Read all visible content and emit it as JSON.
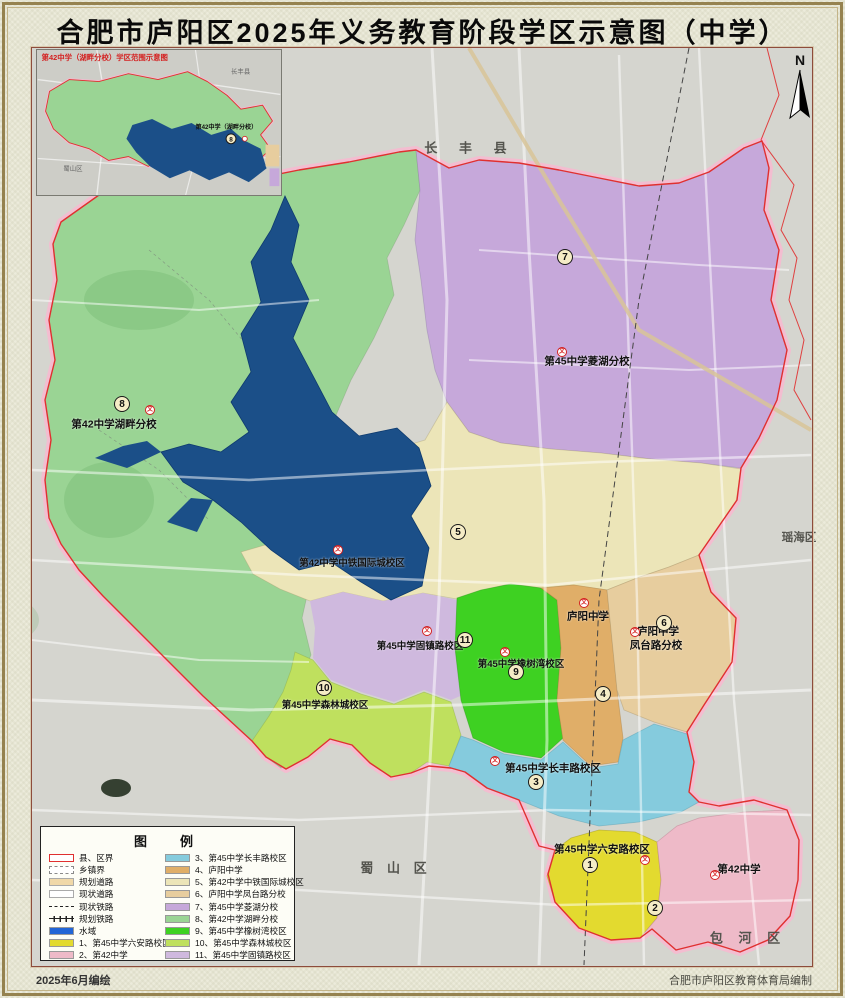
{
  "title": "合肥市庐阳区2025年义务教育阶段学区示意图（中学）",
  "north": {
    "label": "N"
  },
  "inset": {
    "caption": "第42中学（湖畔分校）学区范围示意图",
    "label": "第42中学（湖畔分校）",
    "num": "8",
    "districts": [
      {
        "text": "长丰县"
      },
      {
        "text": "蜀山区"
      }
    ]
  },
  "map": {
    "marker": "文",
    "districts": [
      {
        "text": "长 丰 县"
      },
      {
        "text": "瑶海区"
      },
      {
        "text": "蜀 山 区"
      },
      {
        "text": "包 河 区"
      }
    ],
    "schools": [
      {
        "text": "第45中学菱湖分校"
      },
      {
        "text": "第42中学湖畔分校"
      },
      {
        "text": "第42中学中铁国际城校区"
      },
      {
        "text": "第45中学固镇路校区"
      },
      {
        "text": "庐阳中学"
      },
      {
        "text": "庐阳中学"
      },
      {
        "text": "凤台路分校"
      },
      {
        "text": "第45中学橡树湾校区"
      },
      {
        "text": "第45中学森林城校区"
      },
      {
        "text": "第45中学长丰路校区"
      },
      {
        "text": "第45中学六安路校区"
      },
      {
        "text": "第42中学"
      }
    ],
    "numbers": [
      "1",
      "2",
      "3",
      "4",
      "5",
      "6",
      "7",
      "8",
      "9",
      "10",
      "11"
    ]
  },
  "legend": {
    "title": "图　例",
    "left": [
      {
        "label": "县、区界",
        "fill": "#ffffff"
      },
      {
        "label": "乡镇界",
        "fill": "#ffffff"
      },
      {
        "label": "规划道路",
        "fill": "#f0d8a8"
      },
      {
        "label": "现状道路",
        "fill": "#ffffff"
      },
      {
        "label": "现状铁路",
        "fill": ""
      },
      {
        "label": "规划铁路",
        "fill": ""
      },
      {
        "label": "水域",
        "fill": "#2165d6"
      },
      {
        "label": "1、第45中学六安路校区",
        "fill": "#e3da2f"
      },
      {
        "label": "2、第42中学",
        "fill": "#eebac8"
      }
    ],
    "right": [
      {
        "label": "3、第45中学长丰路校区",
        "fill": "#85cbdd"
      },
      {
        "label": "4、庐阳中学",
        "fill": "#e0ae68"
      },
      {
        "label": "5、第42中学中铁国际城校区",
        "fill": "#ece5b8"
      },
      {
        "label": "6、庐阳中学凤台路分校",
        "fill": "#e7cd9e"
      },
      {
        "label": "7、第45中学菱湖分校",
        "fill": "#c6a8da"
      },
      {
        "label": "8、第42中学湖畔分校",
        "fill": "#9ad494"
      },
      {
        "label": "9、第45中学橡树湾校区",
        "fill": "#3ed122"
      },
      {
        "label": "10、第45中学森林城校区",
        "fill": "#bfe05e"
      },
      {
        "label": "11、第45中学固镇路校区",
        "fill": "#cfb9de"
      }
    ]
  },
  "colors": {
    "boundary_red": "#e03030",
    "glow_pink": "#f8b8d0",
    "lake_blue": "#1b4f88",
    "base_gray": "#d5d5cf",
    "pond_dark": "#23301f"
  },
  "footer": {
    "left": "2025年6月编绘",
    "right": "合肥市庐阳区教育体育局编制"
  }
}
